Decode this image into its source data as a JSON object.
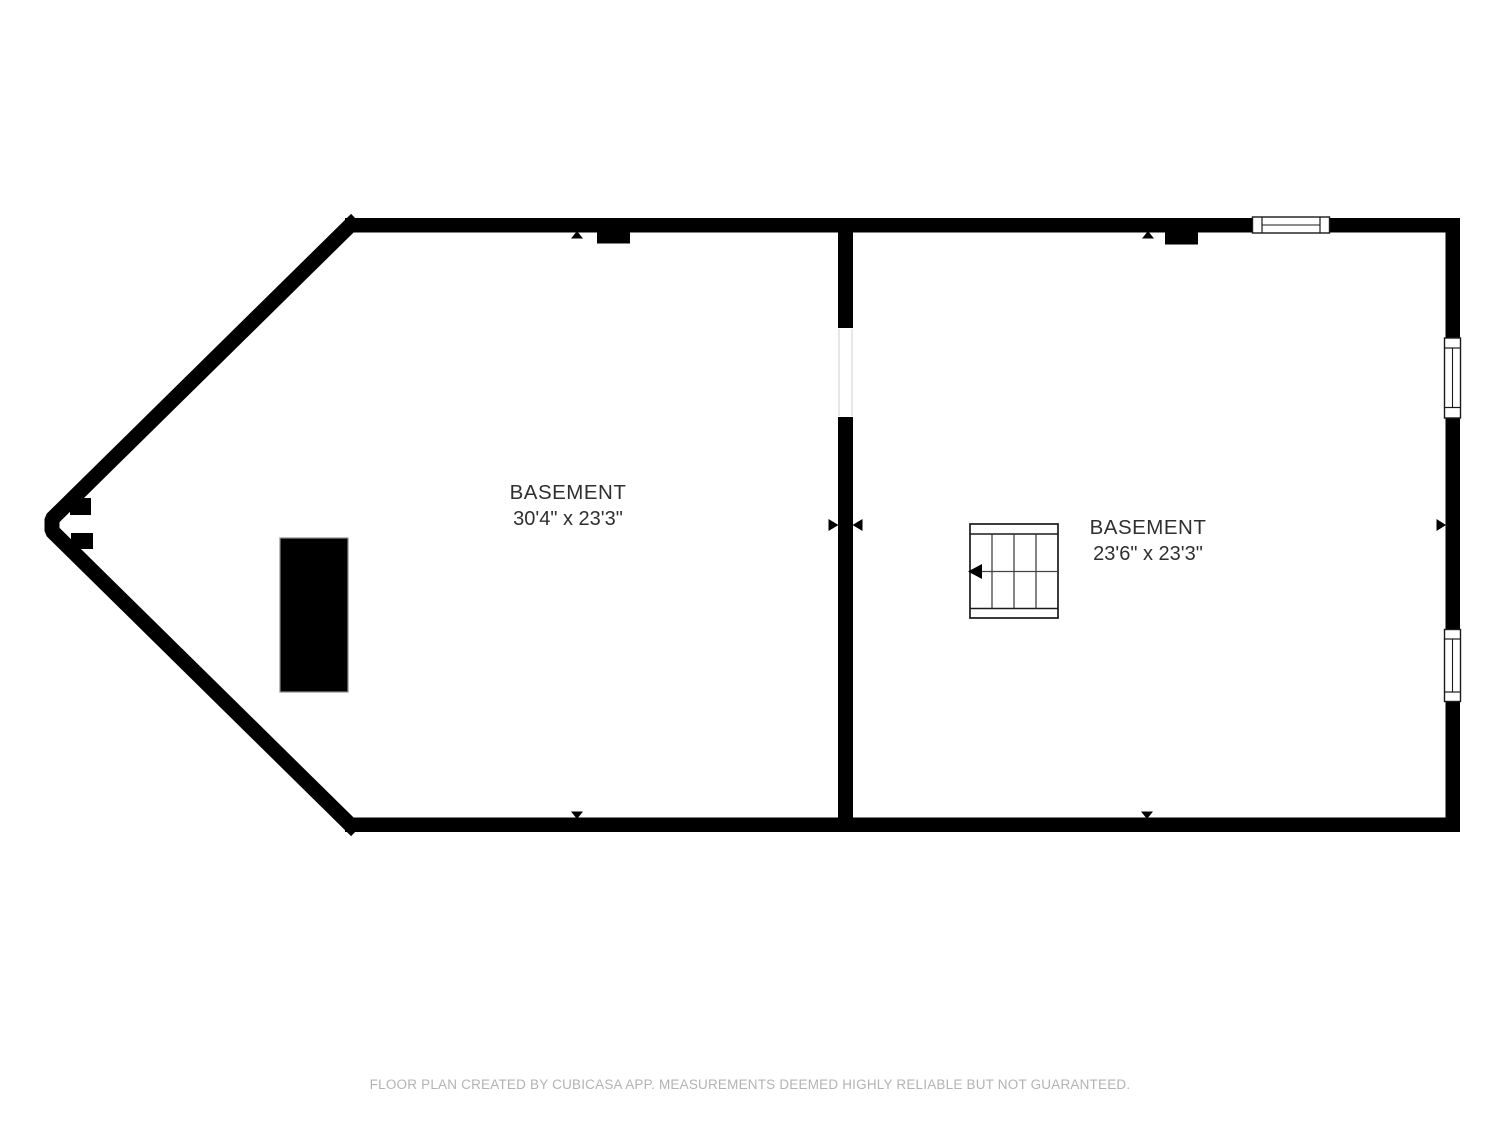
{
  "theme": {
    "wall-color": "#000000",
    "label-color": "#2f2f2f",
    "footer-color": "#b3b3b3",
    "bg-color": "#ffffff",
    "frame-color": "#cfcfcf",
    "outline-color": "#8c8c8c"
  },
  "floor_plan": {
    "type": "basement-floor-plan",
    "rooms": [
      {
        "id": "basement-left",
        "name": "BASEMENT",
        "dimensions": "30'4\" x 23'3\""
      },
      {
        "id": "basement-right",
        "name": "BASEMENT",
        "dimensions": "23'6\" x 23'3\""
      }
    ],
    "features": [
      "stairs-icon",
      "fireplace-icon",
      "window-icon-top-wall",
      "window-icon-right-wall-upper",
      "window-icon-right-wall-lower",
      "door-icon-left-room",
      "door-icon-right-room",
      "door-opening-divider-wall"
    ]
  },
  "footer": {
    "disclaimer": "FLOOR PLAN CREATED BY CUBICASA APP. MEASUREMENTS DEEMED HIGHLY RELIABLE BUT NOT GUARANTEED."
  }
}
